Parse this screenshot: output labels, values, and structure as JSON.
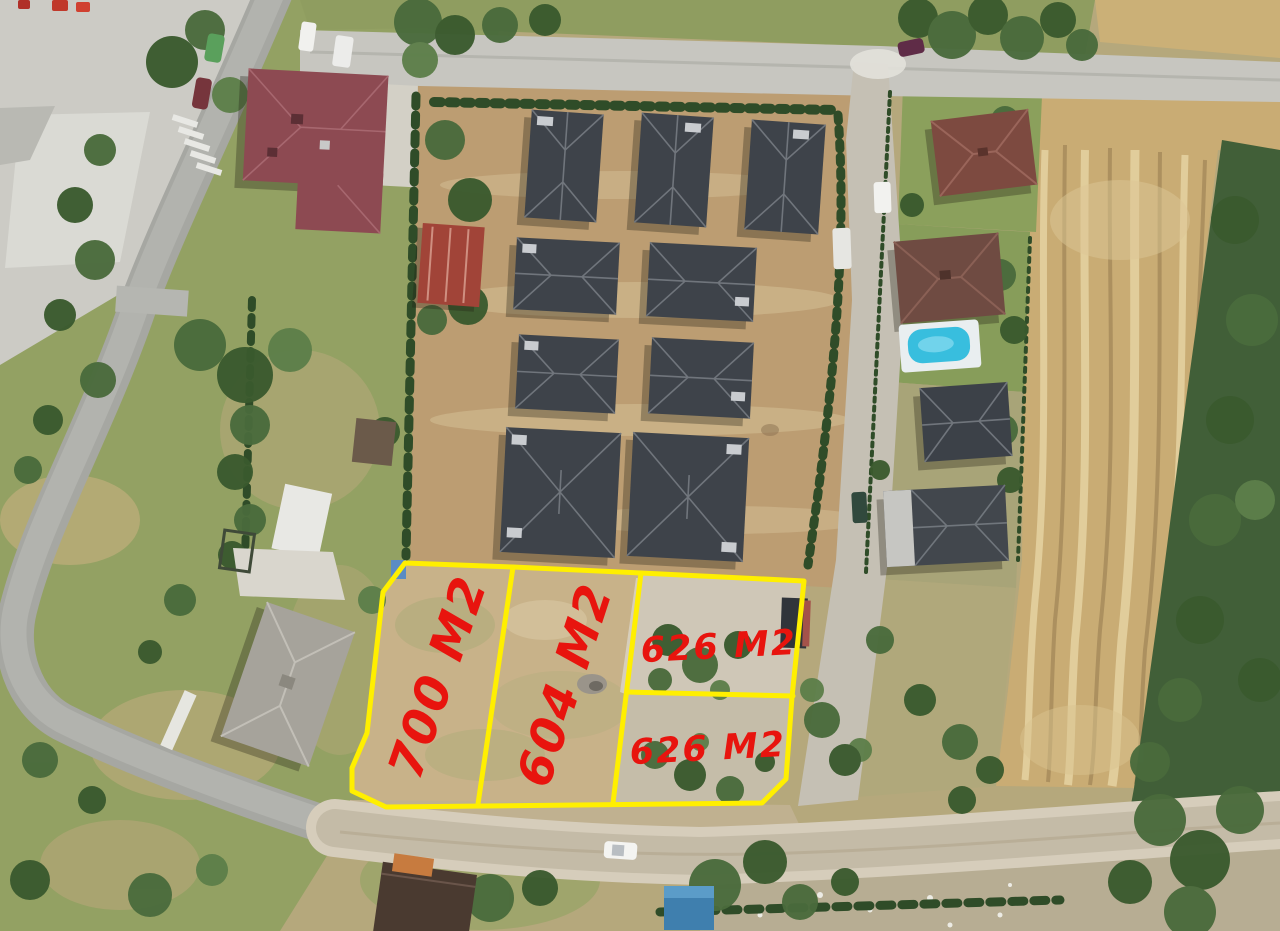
{
  "overlay": {
    "boundary_color": "#ffef00",
    "label_color": "#e8140e",
    "parcels": [
      {
        "id": "parcel-700",
        "label": "700 M2"
      },
      {
        "id": "parcel-604",
        "label": "604 M2"
      },
      {
        "id": "parcel-626-upper",
        "label": "626 M2"
      },
      {
        "id": "parcel-626-lower",
        "label": "626 M2"
      }
    ]
  }
}
